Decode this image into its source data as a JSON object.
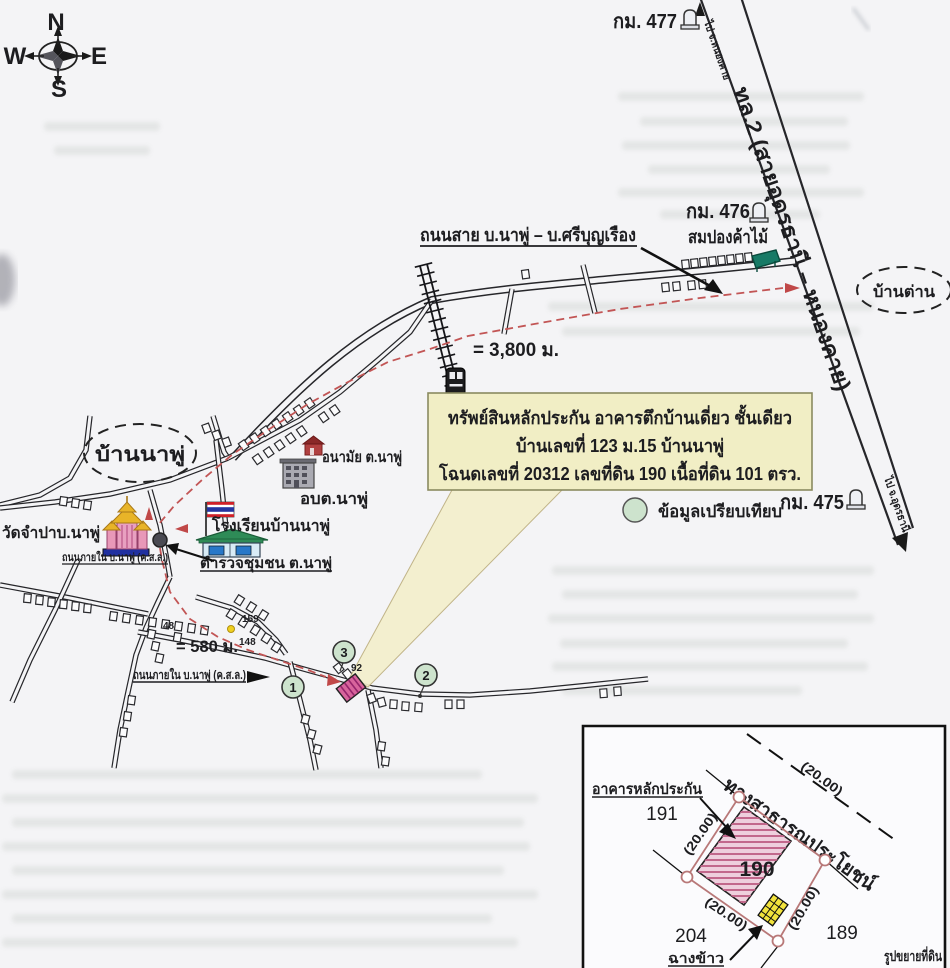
{
  "compass": {
    "n": "N",
    "w": "W",
    "e": "E",
    "s": "S"
  },
  "highway": {
    "name": "ทล.2 (สายอุดรธานี – หนองคาย)",
    "direction_north": "ไป จ.หนองคาย",
    "direction_south": "ไป จ.อุดรธานี",
    "km_markers": [
      "กม. 477",
      "กม. 476",
      "กม. 475"
    ]
  },
  "roads": {
    "main_road_label": "ถนนสาย บ.นาพู่ – บ.ศรีบุญเรือง",
    "village_road_upper": "ถนนภายใน บ.นาพู่ (ค.ส.ล.)",
    "village_road_lower": "ถนนภายใน บ.นาพู่ (ค.ส.ล.)",
    "inset_public_road": "ทางสาธารณประโยชน์"
  },
  "distances": {
    "to_highway": "= 3,800 ม.",
    "village_section": "= 580 ม."
  },
  "areas": {
    "village": "บ้านนาพู่",
    "village_east": "บ้านต่าน"
  },
  "places": {
    "temple": "วัดจำปาบ.นาพู่",
    "health_center": "อนามัย ต.นาพู่",
    "sao": "อบต.นาพู่",
    "school": "โรงเรียนบ้านนาพู่",
    "police": "ตำรวจชุมชน ต.นาพู่",
    "wood_shop": "สมปองค้าไม้"
  },
  "info_box": {
    "line1": "ทรัพย์สินหลักประกัน อาคารตึกบ้านเดี่ยว ชั้นเดียว",
    "line2": "บ้านเลขที่ 123 ม.15 บ้านนาพู่",
    "line3": "โฉนดเลขที่ 20312 เลขที่ดิน 190 เนื้อที่ดิน 101 ตรว."
  },
  "legend": {
    "comparison": "ข้อมูลเปรียบเทียบ"
  },
  "comparison_points": [
    "1",
    "2",
    "3"
  ],
  "house_numbers": {
    "h48": "48",
    "h159": "159",
    "h148": "148",
    "h92": "92"
  },
  "inset": {
    "title": "รูปขยายที่ดิน",
    "collateral_building": "อาคารหลักประกัน",
    "rice_barn": "ฉางข้าว",
    "subject_parcel": "190",
    "parcel_left": "191",
    "parcel_bottom_left": "204",
    "parcel_bottom_right": "189",
    "dim": "(20.00)"
  },
  "colors": {
    "route_red": "#c25555",
    "info_box_bg": "#f1eec5",
    "comparison_fill": "#cde3cd",
    "property_pink": "#d8649c",
    "parcel_outline": "#b87878",
    "barn_yellow": "#f2e33c",
    "paper": "#f4f4f6"
  }
}
